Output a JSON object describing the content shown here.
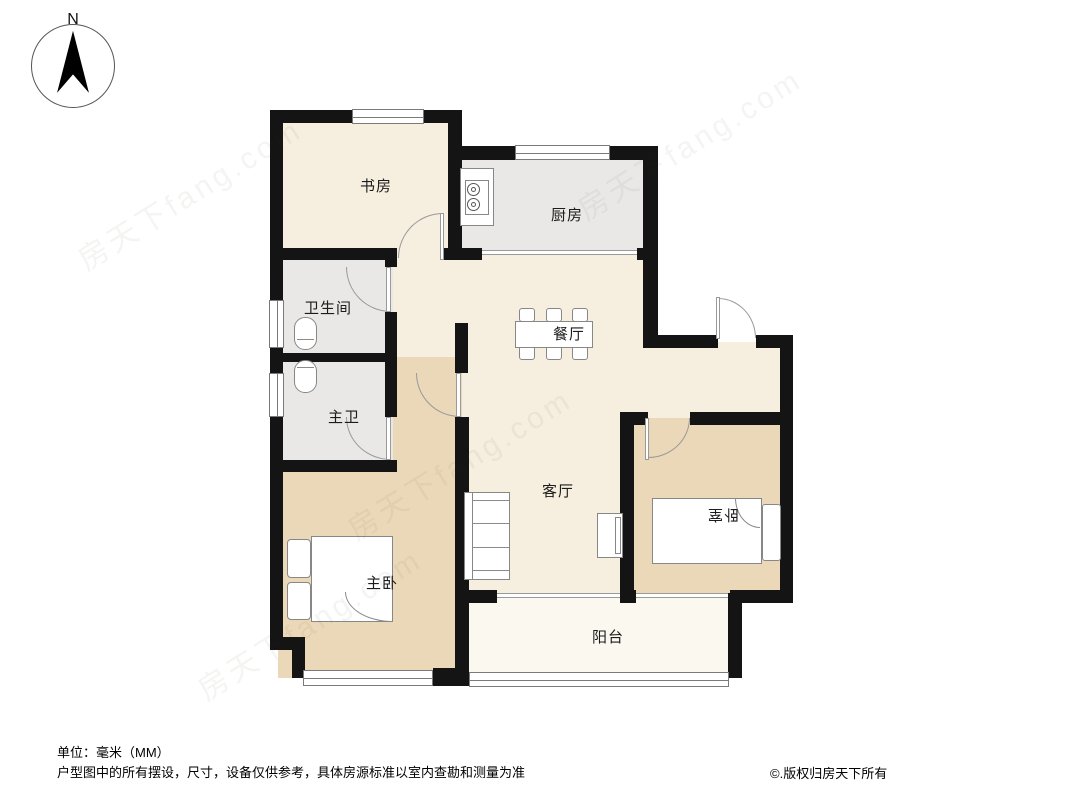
{
  "compass": {
    "north_label": "N"
  },
  "rooms": {
    "study": {
      "label": "书房"
    },
    "kitchen": {
      "label": "厨房"
    },
    "bathroom": {
      "label": "卫生间"
    },
    "master_bath": {
      "label": "主卫"
    },
    "dining": {
      "label": "餐厅"
    },
    "living": {
      "label": "客厅"
    },
    "master_bedroom": {
      "label": "主卧"
    },
    "bedroom": {
      "label": "卧室"
    },
    "balcony": {
      "label": "阳台"
    }
  },
  "watermark": {
    "text": "房天下fang.com"
  },
  "footer": {
    "unit_note": "单位：毫米（MM）",
    "disclaimer": "户型图中的所有摆设，尺寸，设备仅供参考，具体房源标准以室内查勘和测量为准",
    "copyright": "©.版权归房天下所有"
  },
  "colors": {
    "wall": "#141414",
    "room_cream": "#f6eedf",
    "room_tan": "#ebd8b8",
    "room_gray": "#e9e8e6",
    "balcony": "#faf8ef",
    "text": "#1c1c1c"
  }
}
